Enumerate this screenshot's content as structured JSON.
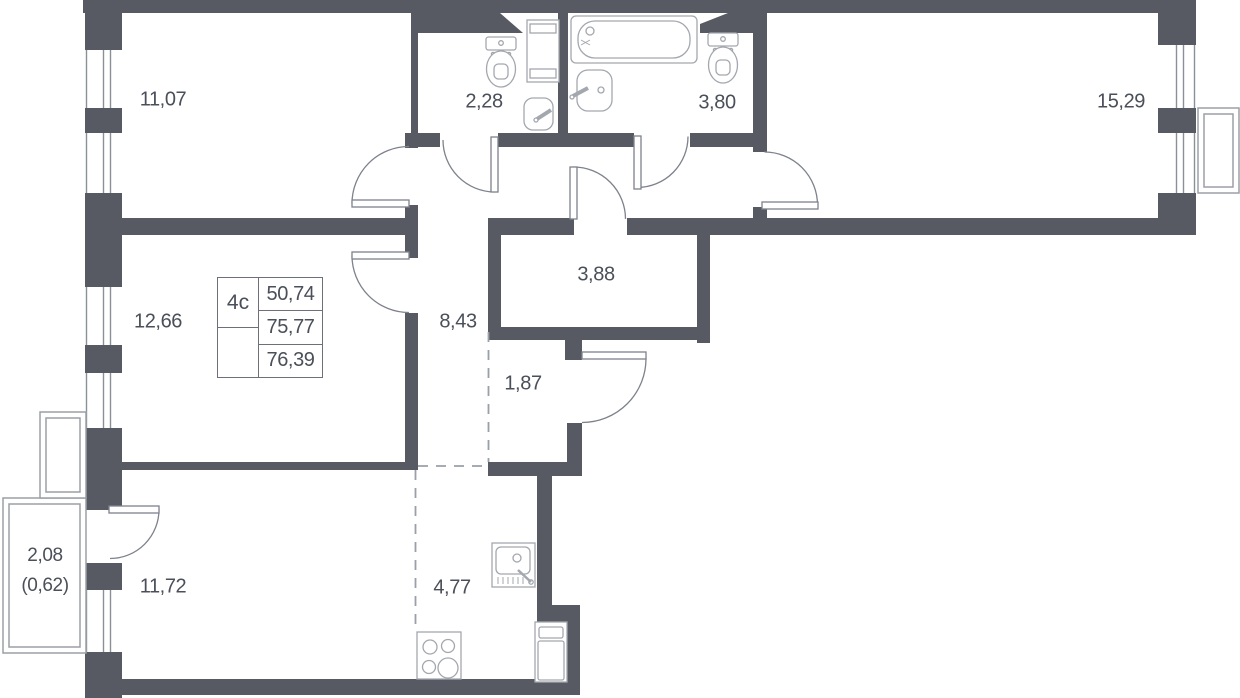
{
  "unit_table": {
    "type_label": "4с",
    "values": [
      "50,74",
      "75,77",
      "76,39"
    ]
  },
  "room_areas": [
    "11,07",
    "2,28",
    "3,80",
    "15,29",
    "12,66",
    "8,43",
    "3,88",
    "1,87",
    "11,72",
    "4,77",
    "2,08",
    "(0,62)"
  ],
  "colors": {
    "wall": "#575a62",
    "fixture_line": "#a3a7ae",
    "door_line": "#7d828c",
    "dash_line": "#9aa0a8",
    "text": "#4a4f59"
  }
}
